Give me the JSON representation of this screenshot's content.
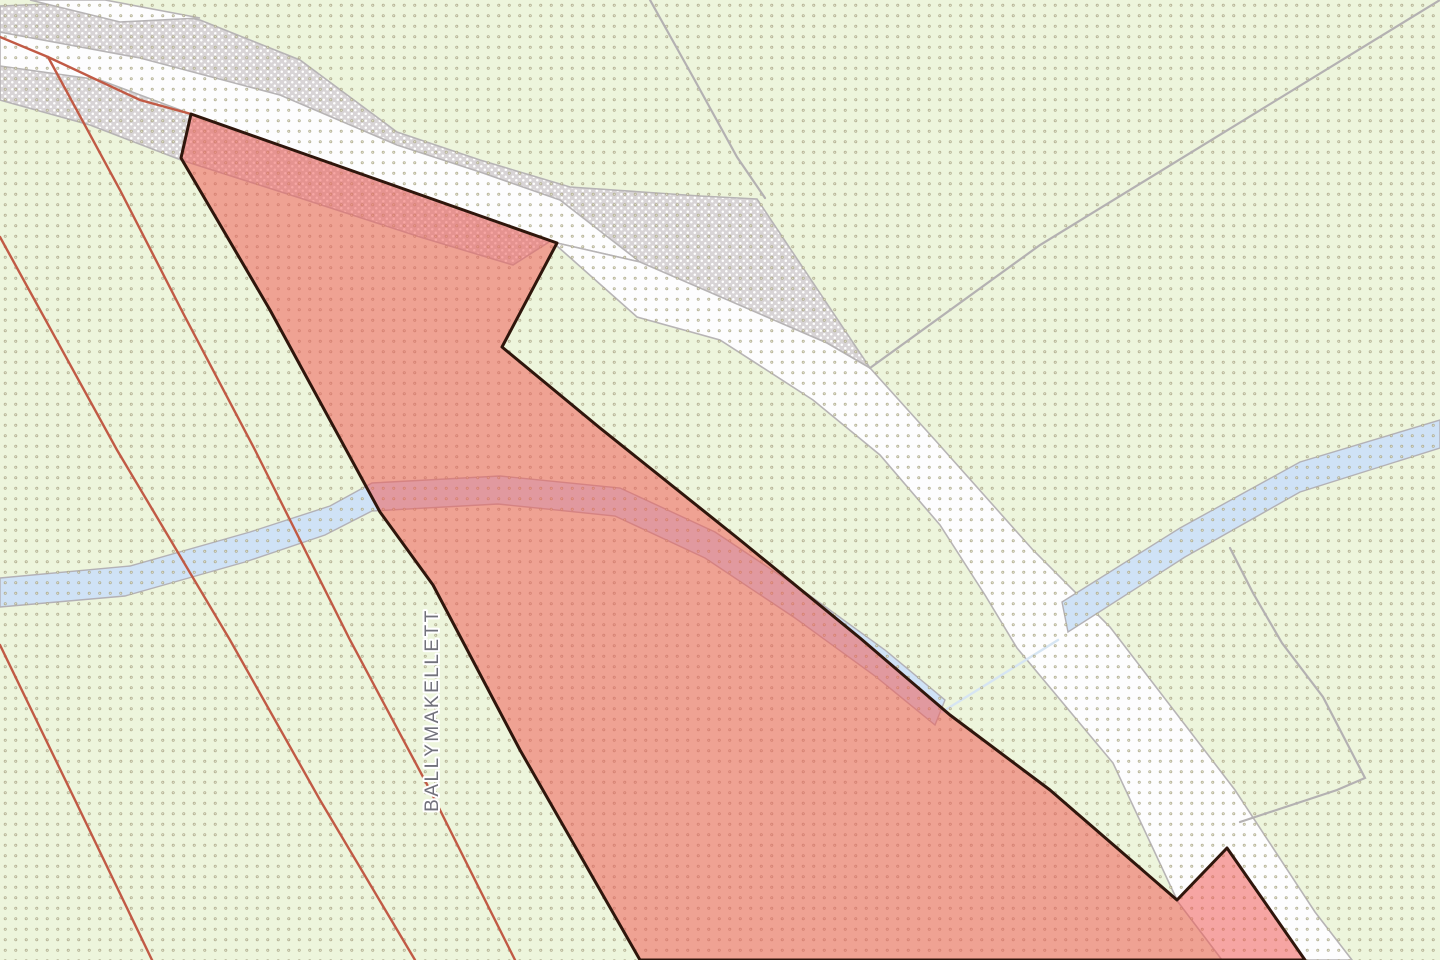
{
  "map": {
    "label": {
      "text": "BALLYMAKELLETT"
    },
    "palette": {
      "background": "#edf5dc",
      "dot_grid": "#a9a385",
      "dot_grid_center": "#eef3da",
      "road_stipple_base": "#d8d4d6",
      "road_stipple_speckle": "#ffffff",
      "road_surface": "#fdfdfe",
      "road_casing": "#b7b4b5",
      "stream_fill": "#cfe2f6",
      "stream_casing": "#b3b1b6",
      "stream_thin_line": "#d6e5f3",
      "field_boundary_gray": "#b4b1b2",
      "parcel_boundary_orange": "#c15a45",
      "highlight_parcel_fill": "rgba(240,92,88,0.55)",
      "highlight_parcel_stroke": "#2f160c",
      "label_fill": "#71717b",
      "label_halo": "#ffffff"
    },
    "patterns": {
      "dots": {
        "size": 10.5,
        "outer_r": 1.5,
        "inner_r": 0.6
      },
      "stipple": {
        "size": 7,
        "speckle_r": 1.25
      }
    },
    "layers": [
      {
        "name": "background",
        "interactable": false,
        "shapes": [
          {
            "kind": "rect",
            "x": 0,
            "y": 0,
            "w": 1440,
            "h": 960,
            "fill": "background"
          }
        ]
      },
      {
        "name": "road-stipple-band",
        "interactable": false,
        "shapes": [
          {
            "kind": "polygon",
            "fill": "@stipple",
            "stroke": "road_casing",
            "sw": 1.6,
            "points": [
              [
                0,
                6
              ],
              [
                100,
                2
              ],
              [
                200,
                20
              ],
              [
                300,
                60
              ],
              [
                397,
                132
              ],
              [
                480,
                160
              ],
              [
                570,
                187
              ],
              [
                700,
                196
              ],
              [
                757,
                199
              ],
              [
                870,
                368
              ],
              [
                827,
                343
              ],
              [
                640,
                263
              ],
              [
                560,
                235
              ],
              [
                513,
                265
              ],
              [
                420,
                237
              ],
              [
                300,
                198
              ],
              [
                181,
                160
              ],
              [
                90,
                125
              ],
              [
                0,
                100
              ]
            ]
          }
        ]
      },
      {
        "name": "road-surface",
        "interactable": false,
        "shapes": [
          {
            "kind": "polygon",
            "fill": "road_surface",
            "stroke": "road_casing",
            "sw": 1.6,
            "points": [
              [
                30,
                0
              ],
              [
                105,
                0
              ],
              [
                200,
                18
              ],
              [
                120,
                22
              ]
            ]
          },
          {
            "kind": "polygon",
            "fill": "road_surface",
            "stroke": "road_casing",
            "sw": 1.6,
            "points": [
              [
                0,
                32
              ],
              [
                140,
                58
              ],
              [
                280,
                95
              ],
              [
                397,
                145
              ],
              [
                480,
                172
              ],
              [
                560,
                200
              ],
              [
                640,
                262
              ],
              [
                557,
                243
              ],
              [
                400,
                188
              ],
              [
                191,
                114
              ],
              [
                100,
                80
              ],
              [
                0,
                66
              ]
            ]
          },
          {
            "kind": "polygon",
            "fill": "road_surface",
            "stroke": "road_casing",
            "sw": 1.6,
            "points": [
              [
                557,
                243
              ],
              [
                640,
                262
              ],
              [
                827,
                343
              ],
              [
                870,
                368
              ],
              [
                935,
                440
              ],
              [
                1033,
                550
              ],
              [
                1110,
                627
              ],
              [
                1235,
                790
              ],
              [
                1315,
                912
              ],
              [
                1352,
                960
              ],
              [
                1222,
                960
              ],
              [
                1178,
                902
              ],
              [
                1113,
                763
              ],
              [
                1017,
                648
              ],
              [
                985,
                595
              ],
              [
                940,
                525
              ],
              [
                880,
                455
              ],
              [
                813,
                400
              ],
              [
                720,
                340
              ],
              [
                637,
                317
              ],
              [
                557,
                246
              ]
            ]
          }
        ]
      },
      {
        "name": "stream",
        "interactable": false,
        "shapes": [
          {
            "kind": "polygon",
            "fill": "stream_fill",
            "stroke": "stream_casing",
            "sw": 1.4,
            "points": [
              [
                0,
                578
              ],
              [
                130,
                566
              ],
              [
                250,
                532
              ],
              [
                330,
                506
              ],
              [
                372,
                483
              ],
              [
                500,
                476
              ],
              [
                620,
                488
              ],
              [
                715,
                532
              ],
              [
                805,
                592
              ],
              [
                885,
                650
              ],
              [
                945,
                700
              ],
              [
                935,
                725
              ],
              [
                875,
                676
              ],
              [
                795,
                618
              ],
              [
                705,
                558
              ],
              [
                615,
                516
              ],
              [
                498,
                504
              ],
              [
                372,
                511
              ],
              [
                325,
                535
              ],
              [
                245,
                562
              ],
              [
                125,
                596
              ],
              [
                0,
                607
              ]
            ]
          },
          {
            "kind": "polyline",
            "stroke": "stream_thin_line",
            "sw": 2.5,
            "points": [
              [
                942,
                712
              ],
              [
                1000,
                676
              ],
              [
                1058,
                640
              ]
            ]
          },
          {
            "kind": "polygon",
            "fill": "stream_fill",
            "stroke": "stream_casing",
            "sw": 1.4,
            "points": [
              [
                1062,
                602
              ],
              [
                1180,
                528
              ],
              [
                1300,
                462
              ],
              [
                1440,
                420
              ],
              [
                1440,
                448
              ],
              [
                1300,
                492
              ],
              [
                1185,
                557
              ],
              [
                1068,
                632
              ]
            ]
          }
        ]
      },
      {
        "name": "dot-grid-overlay",
        "interactable": false,
        "shapes": [
          {
            "kind": "rect",
            "x": 0,
            "y": 0,
            "w": 1440,
            "h": 960,
            "fill": "@dots"
          }
        ]
      },
      {
        "name": "field-boundary-lines",
        "interactable": false,
        "shapes": [
          {
            "kind": "polyline",
            "stroke": "field_boundary_gray",
            "sw": 2.2,
            "points": [
              [
                650,
                0
              ],
              [
                693,
                77
              ],
              [
                737,
                157
              ],
              [
                765,
                198
              ]
            ]
          },
          {
            "kind": "polyline",
            "stroke": "field_boundary_gray",
            "sw": 2.2,
            "points": [
              [
                870,
                368
              ],
              [
                1040,
                245
              ],
              [
                1440,
                0
              ]
            ]
          },
          {
            "kind": "polyline",
            "stroke": "field_boundary_gray",
            "sw": 2.2,
            "points": [
              [
                1230,
                548
              ],
              [
                1253,
                593
              ],
              [
                1282,
                643
              ],
              [
                1323,
                697
              ],
              [
                1365,
                778
              ],
              [
                1337,
                790
              ],
              [
                1240,
                822
              ]
            ]
          }
        ]
      },
      {
        "name": "parcel-boundary-lines-orange",
        "interactable": false,
        "shapes": [
          {
            "kind": "polyline",
            "stroke": "parcel_boundary_orange",
            "sw": 2.4,
            "points": [
              [
                0,
                37
              ],
              [
                48,
                57
              ],
              [
                140,
                100
              ],
              [
                191,
                114
              ]
            ]
          },
          {
            "kind": "polyline",
            "stroke": "parcel_boundary_orange",
            "sw": 2.4,
            "points": [
              [
                48,
                57
              ],
              [
                120,
                190
              ],
              [
                183,
                313
              ],
              [
                255,
                450
              ],
              [
                350,
                640
              ],
              [
                430,
                790
              ],
              [
                515,
                960
              ]
            ]
          },
          {
            "kind": "polyline",
            "stroke": "parcel_boundary_orange",
            "sw": 2.4,
            "points": [
              [
                0,
                237
              ],
              [
                117,
                450
              ],
              [
                230,
                640
              ],
              [
                320,
                800
              ],
              [
                415,
                960
              ]
            ]
          },
          {
            "kind": "polyline",
            "stroke": "parcel_boundary_orange",
            "sw": 2.4,
            "points": [
              [
                0,
                645
              ],
              [
                75,
                800
              ],
              [
                152,
                960
              ]
            ]
          }
        ]
      },
      {
        "name": "highlighted-parcel",
        "interactable": true,
        "shapes": [
          {
            "kind": "polygon",
            "fill": "highlight_parcel_fill",
            "stroke": "highlight_parcel_stroke",
            "sw": 3,
            "join": "round",
            "points": [
              [
                191,
                114
              ],
              [
                557,
                243
              ],
              [
                502,
                347
              ],
              [
                600,
                428
              ],
              [
                740,
                540
              ],
              [
                860,
                638
              ],
              [
                950,
                715
              ],
              [
                1050,
                790
              ],
              [
                1177,
                900
              ],
              [
                1227,
                848
              ],
              [
                1305,
                960
              ],
              [
                640,
                960
              ],
              [
                520,
                750
              ],
              [
                433,
                585
              ],
              [
                380,
                512
              ],
              [
                270,
                310
              ],
              [
                181,
                158
              ]
            ]
          }
        ]
      }
    ]
  }
}
